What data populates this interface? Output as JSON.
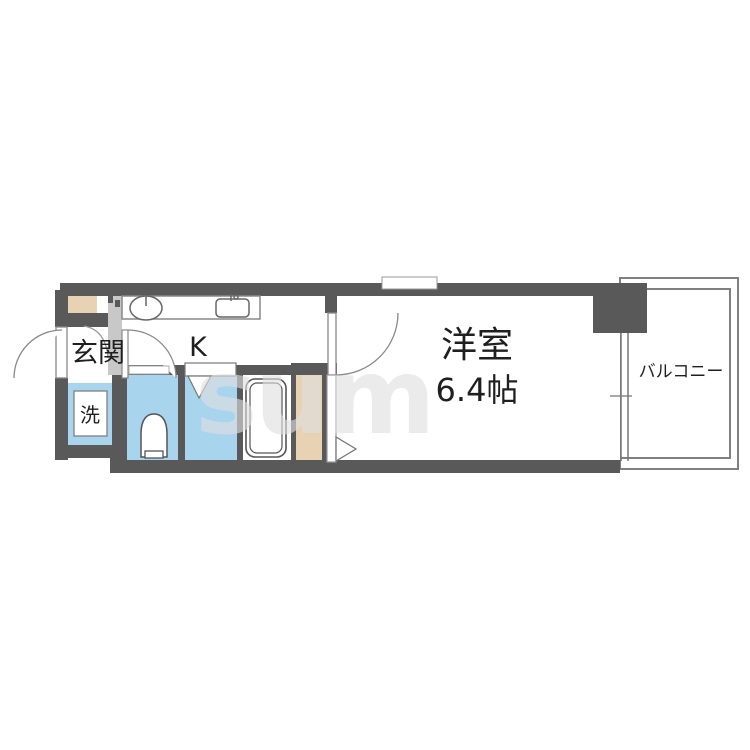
{
  "plan": {
    "type": "apartment-floorplan",
    "rooms": {
      "genkan": {
        "label": "玄関"
      },
      "kitchen": {
        "label": "K"
      },
      "laundry": {
        "label": "洗"
      },
      "western_room": {
        "label": "洋室",
        "size": "6.4帖"
      },
      "balcony": {
        "label": "バルコニー"
      }
    },
    "watermark": "sum",
    "palette": {
      "wall": "#595959",
      "wet_area_blue": "#a8d4ee",
      "closet_beige": "#e7d2b3",
      "pipe_space_gray": "#c8c8c8",
      "outline_gray": "#777777",
      "label_text": "#1f1f1f",
      "watermark_gray": "#dedede"
    }
  }
}
